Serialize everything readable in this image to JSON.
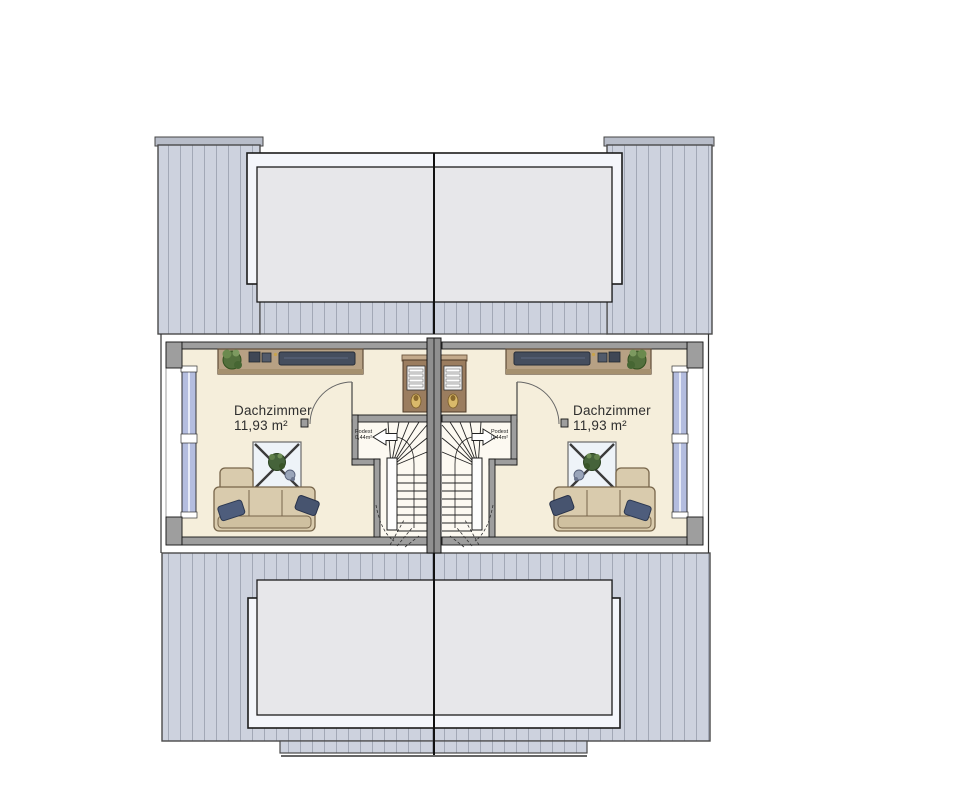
{
  "plan": {
    "kind": "attic floor plan, semi-detached house, two mirrored units"
  },
  "units": {
    "left": {
      "room_label": "Dachzimmer",
      "room_area": "11,93 m²",
      "podest_label": "Podest",
      "podest_area": "0,44m²"
    },
    "right": {
      "room_label": "Dachzimmer",
      "room_area": "11,93 m²",
      "podest_label": "Podest",
      "podest_area": "0,44m²"
    }
  },
  "colors": {
    "roof_fill": "#cdd2de",
    "roof_stripe": "#a2a8b6",
    "roof_cap": "#b8bdc9",
    "dormer_frame": "#f4f6fb",
    "dormer_glass": "#e7e7ea",
    "wall": "#9e9e9e",
    "floor": "#f5eedb",
    "window_glazing": "#b4bddf",
    "sofa": "#d9cbad",
    "wood": "#b7a184",
    "pillow": "#4e5d7c"
  }
}
